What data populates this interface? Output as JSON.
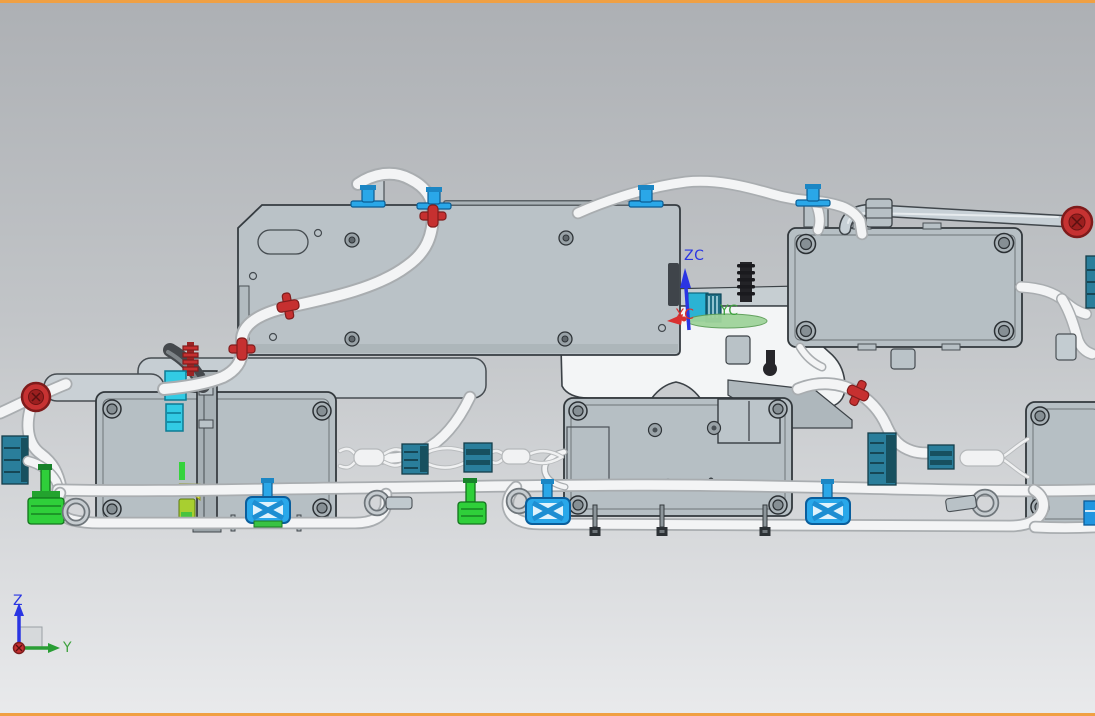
{
  "viewport": {
    "background_top": "#adb0b4",
    "background_bottom": "#e9eaec",
    "active_border_color": "#f0a043"
  },
  "wcs_triad": {
    "z_axis": {
      "label": "ZC",
      "color": "#2a35e3"
    },
    "y_axis": {
      "label": "YC",
      "color": "#3fa23f"
    },
    "x_axis": {
      "label": "XC",
      "color": "#d93030"
    }
  },
  "view_triad": {
    "z_axis": {
      "label": "Z",
      "color": "#2a35e3"
    },
    "y_axis": {
      "label": "Y",
      "color": "#3fa23f"
    },
    "origin_color": "#c53030"
  },
  "part_colors": {
    "panel_fill": "#bac2c7",
    "enclosure_fill": "#b6bfc4",
    "edge_dark": "#32383c",
    "tube_white": "#f3f4f5",
    "tube_outline": "#a9adb0",
    "conduit_gray": "#c7d0d6",
    "clip_red": "#c63030",
    "clip_blue": "#2aa7e8",
    "connector_teal": "#2a7e9b",
    "connector_green": "#2fcf3a",
    "connector_cyan": "#32cbe4",
    "highlight_yellow": "#dce23c",
    "stud_black": "#232327",
    "body_white": "#f3f5f6"
  }
}
